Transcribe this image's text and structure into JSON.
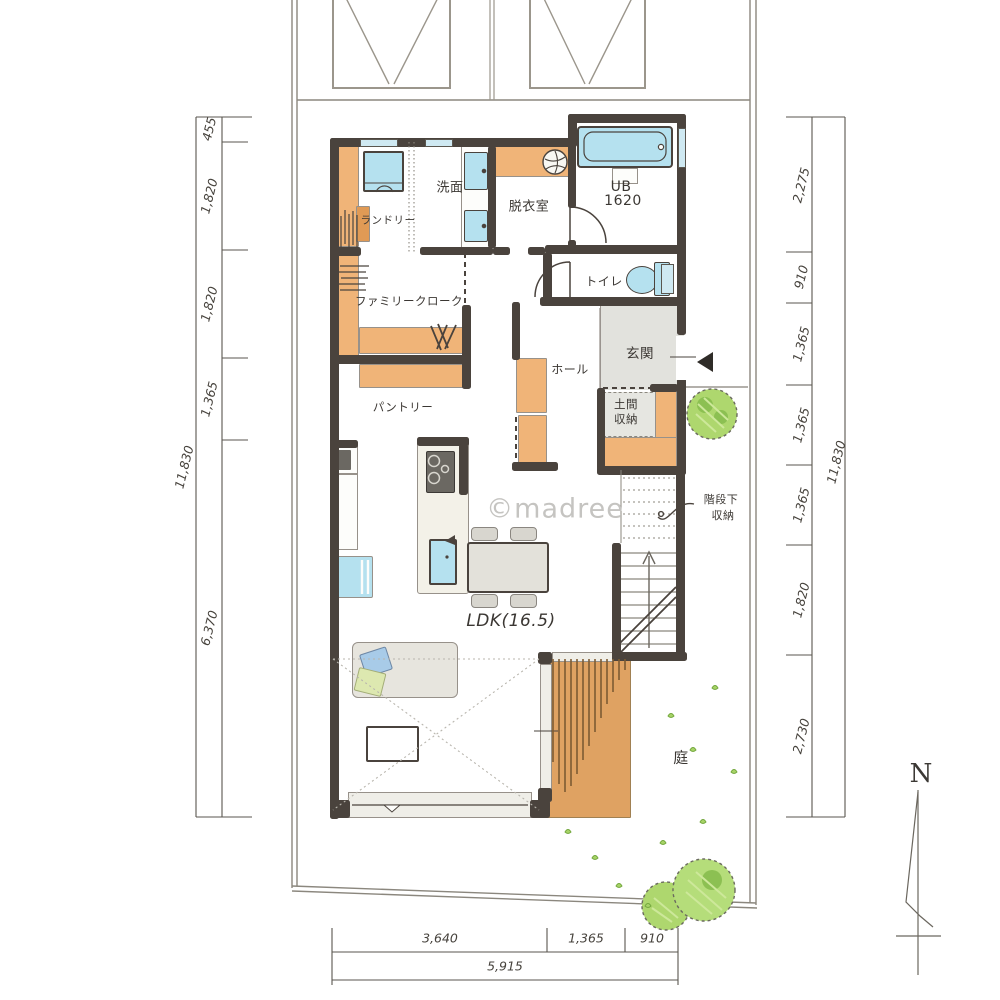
{
  "watermark": "©madree",
  "compass": {
    "north_label": "N"
  },
  "rooms": {
    "laundry": "ランドリー",
    "washroom": "洗面",
    "dressing_room": "脱衣室",
    "bath_label": "UB",
    "bath_size": "1620",
    "toilet": "トイレ",
    "family_closet": "ファミリークローク",
    "hall": "ホール",
    "entrance": "玄関",
    "doma_storage": [
      "土間",
      "収納"
    ],
    "pantry": "パントリー",
    "under_stair_storage": [
      "階段下",
      "収納"
    ],
    "ldk": "LDK(16.5)",
    "garden": "庭"
  },
  "dimensions": {
    "left": {
      "segments": [
        "455",
        "1,820",
        "1,820",
        "1,365",
        "6,370"
      ],
      "total": "11,830"
    },
    "right": {
      "segments": [
        "2,275",
        "910",
        "1,365",
        "1,365",
        "1,365",
        "1,820",
        "2,730"
      ],
      "total": "11,830"
    },
    "bottom": {
      "segments": [
        "3,640",
        "1,365",
        "910"
      ],
      "total": "5,915"
    }
  },
  "colors": {
    "wall": "#4a433d",
    "closet_wood": "#f0b478",
    "deck_wood": "#dfa262",
    "water_fixture": "#b5e1ef",
    "tile_gray": "#e2e2dd",
    "greenery": "#a8d468"
  }
}
